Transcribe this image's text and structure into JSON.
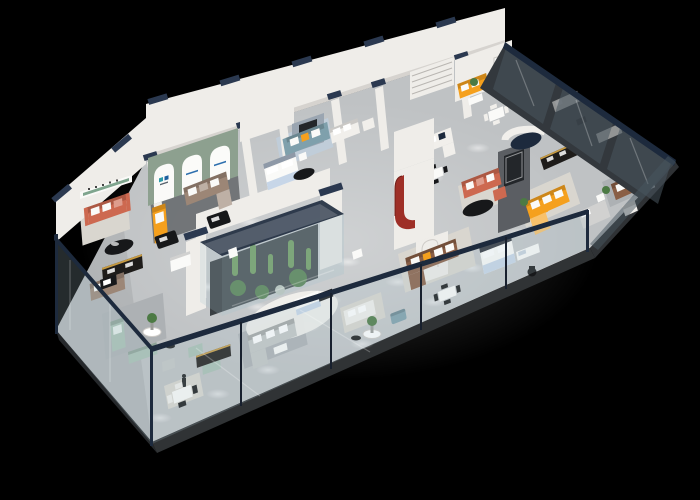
{
  "meta": {
    "title": "3D isometric cutaway floor plan render of a furniture showroom on a black background"
  },
  "palette": {
    "background": "#000000",
    "floor": "#bfc2c4",
    "slab_edge": "#303335",
    "slab_edge_left": "#26292c",
    "wall_white": "#efede9",
    "wall_shade": "#d6d3cf",
    "wall_cap_navy": "#2b3950",
    "rail_navy": "#1d2a3d",
    "glass": "#a8c2cc",
    "glass_dark": "#48565f",
    "rug_light": "#d9d6cf",
    "rug_gray": "#adb1b4",
    "rug_blue": "#c0cdd9",
    "rug_dark": "#63666a",
    "sofa_orange": "#f5a01d",
    "sofa_coral": "#cd6950",
    "sofa_taupe": "#9c8676",
    "sofa_brown": "#8a5f46",
    "sofa_sage": "#a9c1b4",
    "sofa_teal": "#7fa0ac",
    "sofa_white": "#f1efeb",
    "sofa_gray": "#c4c7c6",
    "cushion_white": "#fafaf8",
    "table_black": "#17181a",
    "cabinet_dark": "#1e1c1a",
    "cabinet_gold": "#c69a42",
    "bed_blue": "#c7d6e8",
    "accent_red": "#9e2f27",
    "wall_green": "#8da08f",
    "feature_wall_gray": "#5b5e63",
    "art_panel": "#9aa5b1",
    "art_dark": "#23262a",
    "plant_green": "#4c7a44",
    "cactus_green": "#6b9a58",
    "figure_dark": "#2e3b4e",
    "poster_white": "#f5f5f3"
  },
  "scene": {
    "type": "furniture-showroom-floorplan",
    "rooms": [
      {
        "name": "coral-sofa-lounge",
        "key_color": "sofa_coral"
      },
      {
        "name": "arched-gallery-lounge",
        "key_color": "wall_green"
      },
      {
        "name": "orange-chaise-display",
        "key_color": "sofa_orange"
      },
      {
        "name": "bedroom-display-left",
        "key_color": "bed_blue"
      },
      {
        "name": "teal-sofa-bay",
        "key_color": "sofa_teal"
      },
      {
        "name": "white-sofa-dining-bay",
        "key_color": "sofa_white"
      },
      {
        "name": "striped-feature-wall-bay",
        "key_color": "wall_white"
      },
      {
        "name": "orange-sofa-reception",
        "key_color": "sofa_orange"
      },
      {
        "name": "coral-sofa-feature-lounge",
        "key_color": "sofa_coral"
      },
      {
        "name": "orange-sectional-suite",
        "key_color": "sofa_orange"
      },
      {
        "name": "leather-lounge-right",
        "key_color": "sofa_brown"
      },
      {
        "name": "bedroom-display-center",
        "key_color": "bed_blue"
      },
      {
        "name": "brown-sectional-dining-suite",
        "key_color": "sofa_brown"
      },
      {
        "name": "terrarium-centerpiece",
        "key_color": "cactus_green"
      },
      {
        "name": "sage-green-lounge",
        "key_color": "sofa_sage"
      },
      {
        "name": "display-cabinet-aisle",
        "key_color": "cabinet_dark"
      },
      {
        "name": "gray-sectional-front-bay",
        "key_color": "sofa_gray"
      },
      {
        "name": "front-dining-area",
        "key_color": "sofa_white"
      },
      {
        "name": "office-desk-corner",
        "key_color": "table_black"
      },
      {
        "name": "glass-partition-suites",
        "key_color": "glass_dark"
      }
    ],
    "figures": [
      {
        "name": "saleswoman-poster"
      },
      {
        "name": "visitor-silhouette"
      }
    ],
    "signage": [
      {
        "name": "arch-brand-logo-teal"
      },
      {
        "name": "arch-brand-logo-blue"
      },
      {
        "name": "niche-brand-logo-red"
      },
      {
        "name": "green-stripe-wall-sign"
      }
    ],
    "envelope": [
      {
        "name": "glass-balustrade-front"
      },
      {
        "name": "glass-balustrade-left"
      },
      {
        "name": "glass-wall-northeast"
      },
      {
        "name": "glass-wall-right-end"
      },
      {
        "name": "ceiling-spotlights"
      }
    ]
  }
}
